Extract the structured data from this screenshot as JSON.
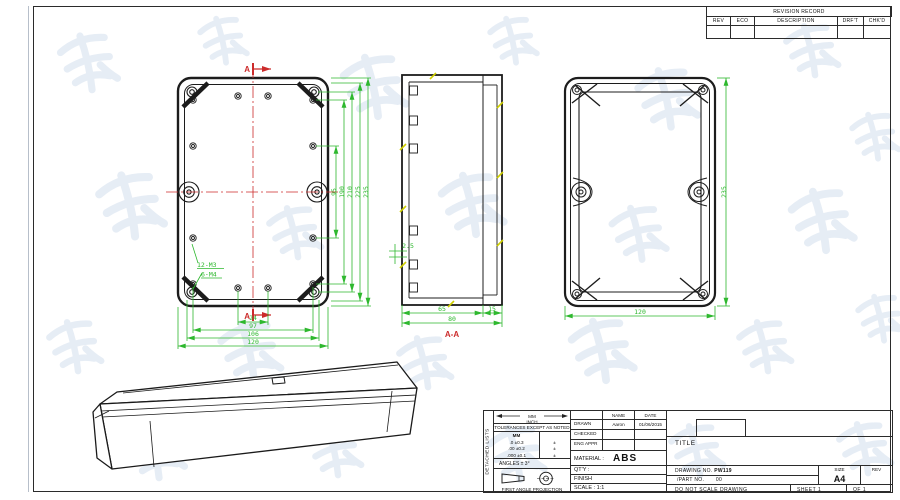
{
  "colors": {
    "line": "#1c1c1c",
    "dimension": "#2eb82e",
    "centerline": "#cc2b2b",
    "hatch": "#cfcf00",
    "watermark": "#e4ebf4"
  },
  "revision_table": {
    "title": "REVISION RECORD",
    "columns": [
      "REV",
      "ECO",
      "DESCRIPTION",
      "DRF'T",
      "CHK'D"
    ]
  },
  "front_view": {
    "section_marker": "A",
    "dims_vertical": [
      "95",
      "190",
      "210",
      "225",
      "235"
    ],
    "dims_horizontal": [
      "24",
      "97",
      "106",
      "120"
    ],
    "thread_labels": [
      "12-M3",
      "6-M4"
    ]
  },
  "section_view": {
    "label": "A-A",
    "dim_step": "2.5",
    "dim_body": "65",
    "dim_lid": "15",
    "dim_total": "80"
  },
  "rear_view": {
    "dim_width": "120",
    "dim_height": "235"
  },
  "title_block": {
    "side_label": "DETACHED LISTS",
    "units_mm": "MM",
    "units_inch": "INCH",
    "tolerance_note": "TOLERANCES EXCEPT AS NOTED",
    "tolerance_header": "MM",
    "tolerances": [
      ".0 ±0.3",
      ".00 ±0.2",
      ".000 ±0.1"
    ],
    "tolerance_marks": [
      "±",
      "±",
      "±"
    ],
    "angles_note": "ANGLES ± 3°",
    "projection_label": "FIRST ANGLE PROJECTION",
    "approval": {
      "name_header": "NAME",
      "date_header": "DATE",
      "rows": [
        {
          "role": "DRAWN",
          "name": "Aaron",
          "date": "01/06/2015"
        },
        {
          "role": "CHECKED",
          "name": "",
          "date": ""
        },
        {
          "role": "ENG APPR",
          "name": "",
          "date": ""
        }
      ]
    },
    "material_label": "MATERIAL :",
    "material_value": "ABS",
    "qty_label": "QT'Y :",
    "finish_label": "FINISH",
    "scale_label": "SCALE : 1:1",
    "title_label": "TITLE",
    "drawing_no_label": "DRAWING NO.",
    "drawing_no_value": "PW119",
    "part_no_label": "/PART NO.",
    "part_no_value": "00",
    "size_label": "SIZE",
    "size_value": "A4",
    "rev_label": "REV",
    "no_scale_note": "DO NOT SCALE DRAWING",
    "sheet_label": "SHEET 1",
    "sheet_of": "OF 1"
  }
}
